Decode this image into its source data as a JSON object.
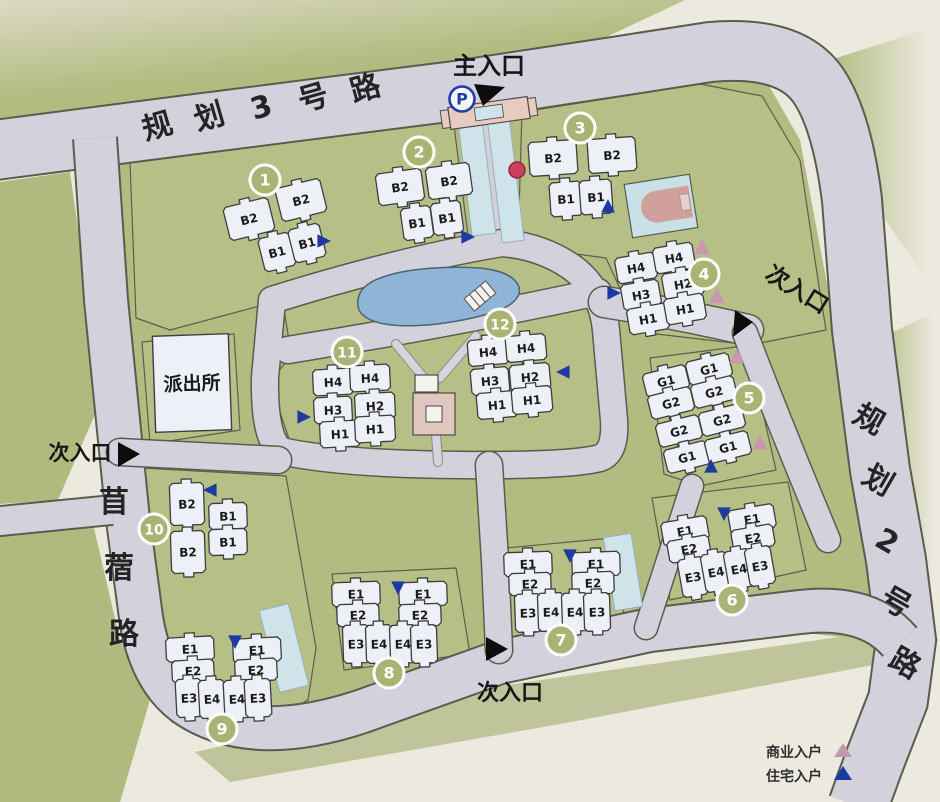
{
  "colors": {
    "paper": "#ece9df",
    "green": "#b6c086",
    "road": "#d3d1dc",
    "building": "#eef0f7",
    "pond": "#8fb5d6",
    "plaza_pink": "#e2c6c0",
    "court_blue": "#c9e0e6",
    "gate_pink": "#e8cabe",
    "circle_olive": "#a9b373",
    "red_dot": "#ce3c5e"
  },
  "roads": {
    "road3": {
      "name": "规划3号路"
    },
    "road2": {
      "name": "规划2号路"
    },
    "muxu": {
      "name": "苜蓿路"
    }
  },
  "entrances": {
    "main": {
      "label": "主入口"
    },
    "right": {
      "label": "次入口"
    },
    "left": {
      "label": "次入口"
    },
    "bottom": {
      "label": "次入口"
    }
  },
  "facilities": {
    "police_station": {
      "label": "派出所"
    },
    "parking": {
      "label": "P"
    }
  },
  "legend": {
    "commercial": {
      "label": "商业入户",
      "color": "#c697ae"
    },
    "residential": {
      "label": "住宅入户",
      "color": "#1e3aa0"
    }
  },
  "clusters": [
    {
      "number": "1",
      "rotation": -14,
      "circle": {
        "x": 265,
        "y": 180
      },
      "buildings": [
        {
          "label": "B2",
          "x": 249,
          "y": 219,
          "w": 46,
          "h": 34
        },
        {
          "label": "B2",
          "x": 301,
          "y": 200,
          "w": 46,
          "h": 34
        },
        {
          "label": "B1",
          "x": 277,
          "y": 252,
          "w": 32,
          "h": 34
        },
        {
          "label": "B1",
          "x": 307,
          "y": 243,
          "w": 32,
          "h": 34
        }
      ],
      "arrows": [
        {
          "type": "residential",
          "x": 323,
          "y": 241,
          "dir": "right"
        }
      ]
    },
    {
      "number": "2",
      "rotation": -8,
      "circle": {
        "x": 419,
        "y": 152
      },
      "buildings": [
        {
          "label": "B2",
          "x": 400,
          "y": 187,
          "w": 46,
          "h": 32
        },
        {
          "label": "B2",
          "x": 449,
          "y": 181,
          "w": 44,
          "h": 32
        },
        {
          "label": "B1",
          "x": 417,
          "y": 223,
          "w": 30,
          "h": 32
        },
        {
          "label": "B1",
          "x": 447,
          "y": 218,
          "w": 30,
          "h": 32
        }
      ],
      "arrows": [
        {
          "type": "residential",
          "x": 467,
          "y": 237,
          "dir": "right"
        }
      ]
    },
    {
      "number": "3",
      "rotation": -4,
      "circle": {
        "x": 580,
        "y": 128
      },
      "buildings": [
        {
          "label": "B2",
          "x": 553,
          "y": 158,
          "w": 48,
          "h": 34
        },
        {
          "label": "B2",
          "x": 612,
          "y": 155,
          "w": 48,
          "h": 34
        },
        {
          "label": "B1",
          "x": 566,
          "y": 199,
          "w": 32,
          "h": 34
        },
        {
          "label": "B1",
          "x": 596,
          "y": 197,
          "w": 32,
          "h": 34
        }
      ],
      "arrows": [
        {
          "type": "residential",
          "x": 608,
          "y": 207,
          "dir": "up"
        }
      ]
    },
    {
      "number": "4",
      "rotation": -10,
      "circle": {
        "x": 704,
        "y": 274
      },
      "buildings": [
        {
          "label": "H4",
          "x": 636,
          "y": 268,
          "w": 40,
          "h": 26
        },
        {
          "label": "H4",
          "x": 674,
          "y": 258,
          "w": 40,
          "h": 26
        },
        {
          "label": "H3",
          "x": 641,
          "y": 295,
          "w": 38,
          "h": 26
        },
        {
          "label": "H2",
          "x": 683,
          "y": 284,
          "w": 40,
          "h": 26
        },
        {
          "label": "H1",
          "x": 648,
          "y": 319,
          "w": 40,
          "h": 26
        },
        {
          "label": "H1",
          "x": 685,
          "y": 309,
          "w": 40,
          "h": 26
        }
      ],
      "arrows": [
        {
          "type": "residential",
          "x": 613,
          "y": 293,
          "dir": "right"
        },
        {
          "type": "commercial",
          "x": 702,
          "y": 248,
          "dir": "up"
        },
        {
          "type": "commercial",
          "x": 717,
          "y": 297,
          "dir": "up"
        }
      ]
    },
    {
      "number": "5",
      "rotation": -14,
      "circle": {
        "x": 749,
        "y": 398
      },
      "buildings": [
        {
          "label": "G1",
          "x": 666,
          "y": 381,
          "w": 44,
          "h": 24
        },
        {
          "label": "G2",
          "x": 671,
          "y": 403,
          "w": 44,
          "h": 24
        },
        {
          "label": "G2",
          "x": 679,
          "y": 431,
          "w": 44,
          "h": 24
        },
        {
          "label": "G1",
          "x": 687,
          "y": 457,
          "w": 44,
          "h": 24
        },
        {
          "label": "G1",
          "x": 709,
          "y": 369,
          "w": 44,
          "h": 24
        },
        {
          "label": "G2",
          "x": 714,
          "y": 392,
          "w": 44,
          "h": 24
        },
        {
          "label": "G2",
          "x": 722,
          "y": 420,
          "w": 44,
          "h": 24
        },
        {
          "label": "G1",
          "x": 728,
          "y": 447,
          "w": 44,
          "h": 24
        }
      ],
      "arrows": [
        {
          "type": "commercial",
          "x": 737,
          "y": 357,
          "dir": "up"
        },
        {
          "type": "commercial",
          "x": 760,
          "y": 443,
          "dir": "up"
        },
        {
          "type": "residential",
          "x": 711,
          "y": 467,
          "dir": "up"
        }
      ]
    },
    {
      "number": "6",
      "rotation": -10,
      "circle": {
        "x": 732,
        "y": 600
      },
      "buildings": [
        {
          "label": "E1",
          "x": 685,
          "y": 531,
          "w": 46,
          "h": 24
        },
        {
          "label": "E1",
          "x": 752,
          "y": 519,
          "w": 46,
          "h": 24
        },
        {
          "label": "E2",
          "x": 689,
          "y": 549,
          "w": 42,
          "h": 22
        },
        {
          "label": "E2",
          "x": 753,
          "y": 538,
          "w": 42,
          "h": 22
        },
        {
          "label": "E3",
          "x": 693,
          "y": 577,
          "w": 26,
          "h": 38
        },
        {
          "label": "E4",
          "x": 716,
          "y": 572,
          "w": 26,
          "h": 38
        },
        {
          "label": "E4",
          "x": 739,
          "y": 569,
          "w": 26,
          "h": 38
        },
        {
          "label": "E3",
          "x": 760,
          "y": 566,
          "w": 26,
          "h": 38
        }
      ],
      "arrows": [
        {
          "type": "residential",
          "x": 724,
          "y": 513,
          "dir": "down"
        }
      ]
    },
    {
      "number": "7",
      "rotation": -2,
      "circle": {
        "x": 561,
        "y": 640
      },
      "buildings": [
        {
          "label": "E1",
          "x": 528,
          "y": 564,
          "w": 48,
          "h": 24
        },
        {
          "label": "E1",
          "x": 596,
          "y": 564,
          "w": 48,
          "h": 24
        },
        {
          "label": "E2",
          "x": 530,
          "y": 584,
          "w": 42,
          "h": 22
        },
        {
          "label": "E2",
          "x": 593,
          "y": 583,
          "w": 42,
          "h": 22
        },
        {
          "label": "E3",
          "x": 528,
          "y": 613,
          "w": 26,
          "h": 38
        },
        {
          "label": "E4",
          "x": 551,
          "y": 612,
          "w": 26,
          "h": 38
        },
        {
          "label": "E4",
          "x": 575,
          "y": 612,
          "w": 26,
          "h": 38
        },
        {
          "label": "E3",
          "x": 597,
          "y": 612,
          "w": 26,
          "h": 38
        }
      ],
      "arrows": [
        {
          "type": "residential",
          "x": 570,
          "y": 555,
          "dir": "down"
        }
      ]
    },
    {
      "number": "8",
      "rotation": -2,
      "circle": {
        "x": 389,
        "y": 673
      },
      "buildings": [
        {
          "label": "E1",
          "x": 356,
          "y": 594,
          "w": 48,
          "h": 24
        },
        {
          "label": "E1",
          "x": 423,
          "y": 594,
          "w": 48,
          "h": 24
        },
        {
          "label": "E2",
          "x": 358,
          "y": 615,
          "w": 42,
          "h": 22
        },
        {
          "label": "E2",
          "x": 420,
          "y": 615,
          "w": 42,
          "h": 22
        },
        {
          "label": "E3",
          "x": 356,
          "y": 644,
          "w": 26,
          "h": 38
        },
        {
          "label": "E4",
          "x": 379,
          "y": 644,
          "w": 26,
          "h": 38
        },
        {
          "label": "E4",
          "x": 403,
          "y": 644,
          "w": 26,
          "h": 38
        },
        {
          "label": "E3",
          "x": 424,
          "y": 644,
          "w": 26,
          "h": 38
        }
      ],
      "arrows": [
        {
          "type": "residential",
          "x": 398,
          "y": 587,
          "dir": "down"
        }
      ]
    },
    {
      "number": "9",
      "rotation": -3,
      "circle": {
        "x": 222,
        "y": 729
      },
      "buildings": [
        {
          "label": "E1",
          "x": 190,
          "y": 649,
          "w": 48,
          "h": 24
        },
        {
          "label": "E1",
          "x": 257,
          "y": 650,
          "w": 48,
          "h": 24
        },
        {
          "label": "E2",
          "x": 193,
          "y": 671,
          "w": 42,
          "h": 22
        },
        {
          "label": "E2",
          "x": 256,
          "y": 670,
          "w": 42,
          "h": 22
        },
        {
          "label": "E3",
          "x": 189,
          "y": 698,
          "w": 26,
          "h": 38
        },
        {
          "label": "E4",
          "x": 212,
          "y": 699,
          "w": 26,
          "h": 38
        },
        {
          "label": "E4",
          "x": 237,
          "y": 699,
          "w": 26,
          "h": 38
        },
        {
          "label": "E3",
          "x": 258,
          "y": 698,
          "w": 26,
          "h": 38
        }
      ],
      "arrows": [
        {
          "type": "residential",
          "x": 235,
          "y": 641,
          "dir": "down"
        }
      ]
    },
    {
      "number": "10",
      "rotation": -2,
      "circle": {
        "x": 154,
        "y": 529
      },
      "buildings": [
        {
          "label": "B2",
          "x": 187,
          "y": 504,
          "w": 34,
          "h": 42
        },
        {
          "label": "B1",
          "x": 228,
          "y": 516,
          "w": 38,
          "h": 26
        },
        {
          "label": "B1",
          "x": 228,
          "y": 542,
          "w": 38,
          "h": 26
        },
        {
          "label": "B2",
          "x": 188,
          "y": 552,
          "w": 34,
          "h": 42
        }
      ],
      "arrows": [
        {
          "type": "residential",
          "x": 211,
          "y": 490,
          "dir": "left"
        }
      ]
    },
    {
      "number": "11",
      "rotation": -3,
      "circle": {
        "x": 347,
        "y": 352
      },
      "buildings": [
        {
          "label": "H4",
          "x": 333,
          "y": 382,
          "w": 40,
          "h": 26
        },
        {
          "label": "H4",
          "x": 370,
          "y": 378,
          "w": 40,
          "h": 26
        },
        {
          "label": "H3",
          "x": 333,
          "y": 410,
          "w": 38,
          "h": 26
        },
        {
          "label": "H2",
          "x": 375,
          "y": 406,
          "w": 40,
          "h": 26
        },
        {
          "label": "H1",
          "x": 340,
          "y": 434,
          "w": 40,
          "h": 26
        },
        {
          "label": "H1",
          "x": 375,
          "y": 429,
          "w": 40,
          "h": 26
        }
      ],
      "arrows": [
        {
          "type": "residential",
          "x": 303,
          "y": 417,
          "dir": "right"
        }
      ]
    },
    {
      "number": "12",
      "rotation": -5,
      "circle": {
        "x": 500,
        "y": 324
      },
      "buildings": [
        {
          "label": "H4",
          "x": 488,
          "y": 352,
          "w": 40,
          "h": 26
        },
        {
          "label": "H4",
          "x": 526,
          "y": 348,
          "w": 40,
          "h": 26
        },
        {
          "label": "H3",
          "x": 490,
          "y": 381,
          "w": 38,
          "h": 26
        },
        {
          "label": "H2",
          "x": 530,
          "y": 377,
          "w": 40,
          "h": 26
        },
        {
          "label": "H1",
          "x": 497,
          "y": 405,
          "w": 40,
          "h": 26
        },
        {
          "label": "H1",
          "x": 532,
          "y": 400,
          "w": 40,
          "h": 26
        }
      ],
      "arrows": [
        {
          "type": "residential",
          "x": 564,
          "y": 372,
          "dir": "left"
        }
      ]
    }
  ]
}
